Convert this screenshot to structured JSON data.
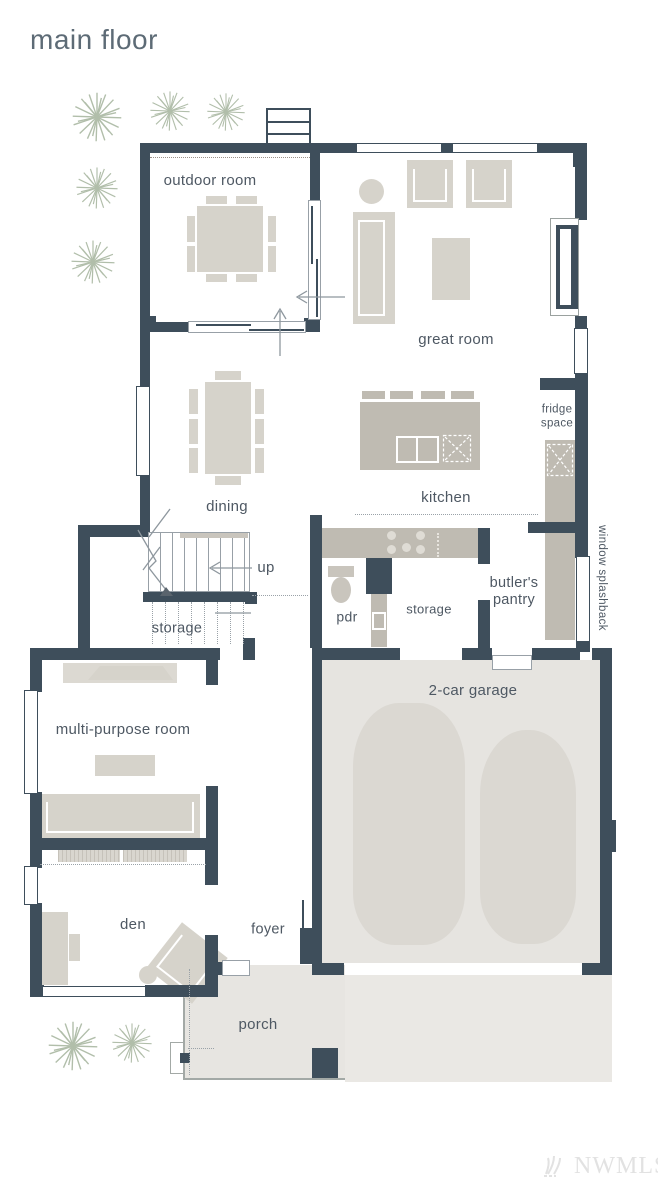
{
  "title": "main floor",
  "rooms": {
    "outdoor_room": "outdoor room",
    "great_room": "great room",
    "dining": "dining",
    "kitchen": "kitchen",
    "fridge_space": "fridge\nspace",
    "butlers_pantry": "butler's\npantry",
    "pdr": "pdr",
    "storage_hall": "storage",
    "up": "up",
    "storage_understair": "storage",
    "multi_purpose": "multi-purpose room",
    "garage": "2-car garage",
    "den": "den",
    "foyer": "foyer",
    "porch": "porch",
    "window_splashback": "window splashback"
  },
  "watermark": "NWMLS",
  "colors": {
    "wall": "#3e4e5b",
    "furniture": "#d6d3cb",
    "counter": "#bfbbb2",
    "garage_floor": "#e6e4e0",
    "plant": "#a4b39c",
    "label": "#4e5863"
  }
}
